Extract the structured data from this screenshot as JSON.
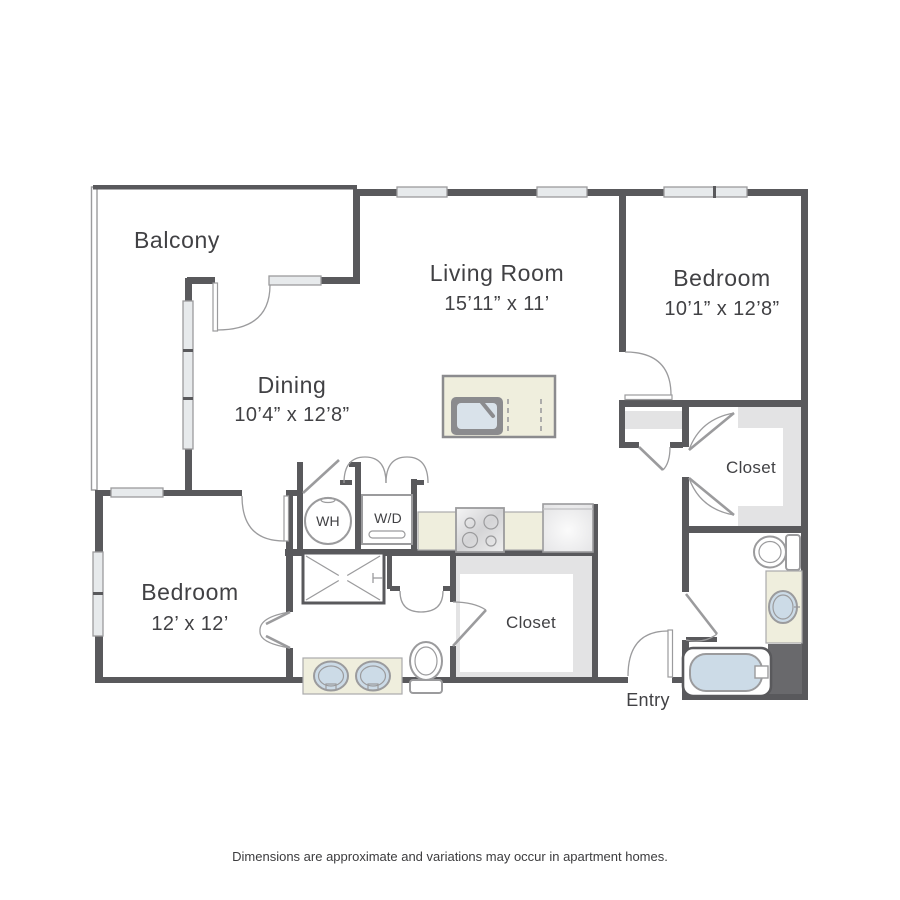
{
  "floorplan": {
    "rooms": {
      "balcony": {
        "name": "Balcony"
      },
      "living_room": {
        "name": "Living Room",
        "dims": "15’11” x 11’"
      },
      "dining": {
        "name": "Dining",
        "dims": "10’4” x 12’8”"
      },
      "bedroom_right": {
        "name": "Bedroom",
        "dims": "10’1” x 12’8”"
      },
      "bedroom_left": {
        "name": "Bedroom",
        "dims": "12’ x 12’"
      },
      "closet_right": {
        "name": "Closet"
      },
      "closet_middle": {
        "name": "Closet"
      },
      "entry": {
        "name": "Entry"
      }
    },
    "appliances": {
      "water_heater": "WH",
      "washer_dryer": "W/D"
    },
    "disclaimer": "Dimensions are approximate and variations may occur in apartment homes.",
    "colors": {
      "wall": "#59595c",
      "thin_line": "#9b9b9d",
      "window_fill": "#e7eaec",
      "shelf": "#e3e3e4",
      "counter": "#efeedd",
      "water": "#ccdbe7",
      "chase": "#69696c",
      "text": "#414144"
    }
  }
}
